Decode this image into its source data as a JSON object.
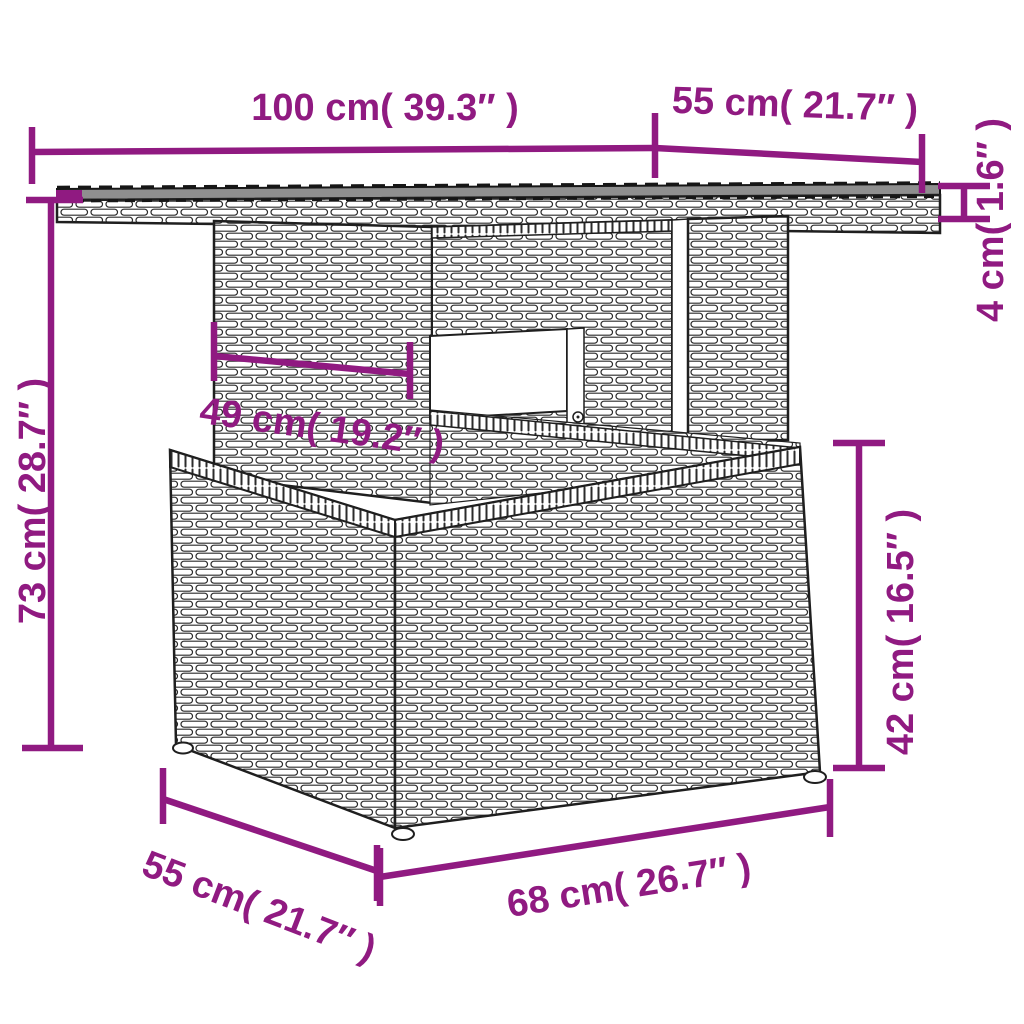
{
  "diagram": {
    "description": "Poly rattan garden table dimension diagram",
    "accent_color": "#901A81",
    "line_color": "#1f1f1f",
    "tabletop_color": "#8f8f8f",
    "dimensions": {
      "top_width": {
        "label": "100 cm( 39.3″ )"
      },
      "top_depth": {
        "label": "55 cm( 21.7″ )"
      },
      "top_thickness": {
        "label": "4 cm( 1.6″ )"
      },
      "total_height": {
        "label": "73 cm( 28.7″ )"
      },
      "pedestal_width": {
        "label": "49 cm( 19.2″ )"
      },
      "base_height": {
        "label": "42 cm( 16.5″ )"
      },
      "base_depth": {
        "label": "55 cm( 21.7″ )"
      },
      "base_width": {
        "label": "68 cm( 26.7″ )"
      }
    }
  }
}
